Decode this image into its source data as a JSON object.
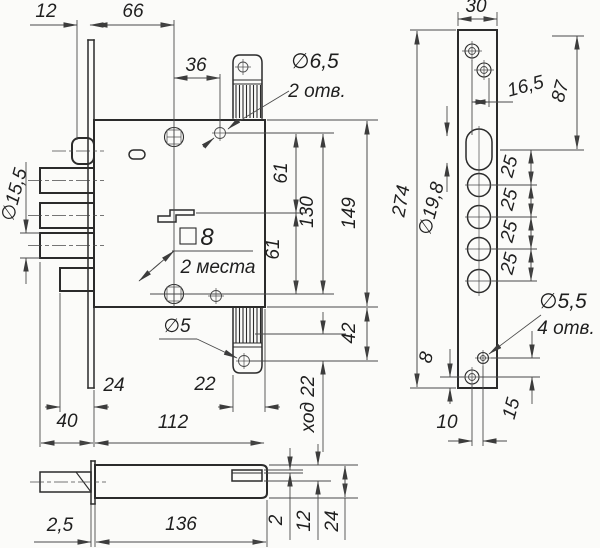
{
  "drawing": {
    "background": "#fbfbf9",
    "line_color": "#2b2b2b",
    "dim_color": "#4a4a4a",
    "labels": {
      "main": {
        "l12": "12",
        "l66": "66",
        "l36": "36",
        "l65d": "∅6,5",
        "l65n": "2 отв.",
        "l155": "∅15,5",
        "l8": "8",
        "l2m": "2 места",
        "l5": "∅5",
        "l61": "61",
        "l130": "130",
        "l149": "149",
        "l42": "42",
        "lhod": "ход 22",
        "l24": "24",
        "l22": "22",
        "l40": "40",
        "l112": "112"
      },
      "side": {
        "l30": "30",
        "l165": "16,5",
        "l87": "87",
        "l274": "274",
        "l198": "∅19,8",
        "s25": [
          "25",
          "25",
          "25",
          "25"
        ],
        "l55d": "∅5,5",
        "l55n": "4 отв.",
        "l8": "8",
        "l15": "15",
        "l10": "10"
      },
      "bottom": {
        "l25": "2,5",
        "l136": "136",
        "l2": "2",
        "l12": "12",
        "l24": "24"
      }
    }
  }
}
